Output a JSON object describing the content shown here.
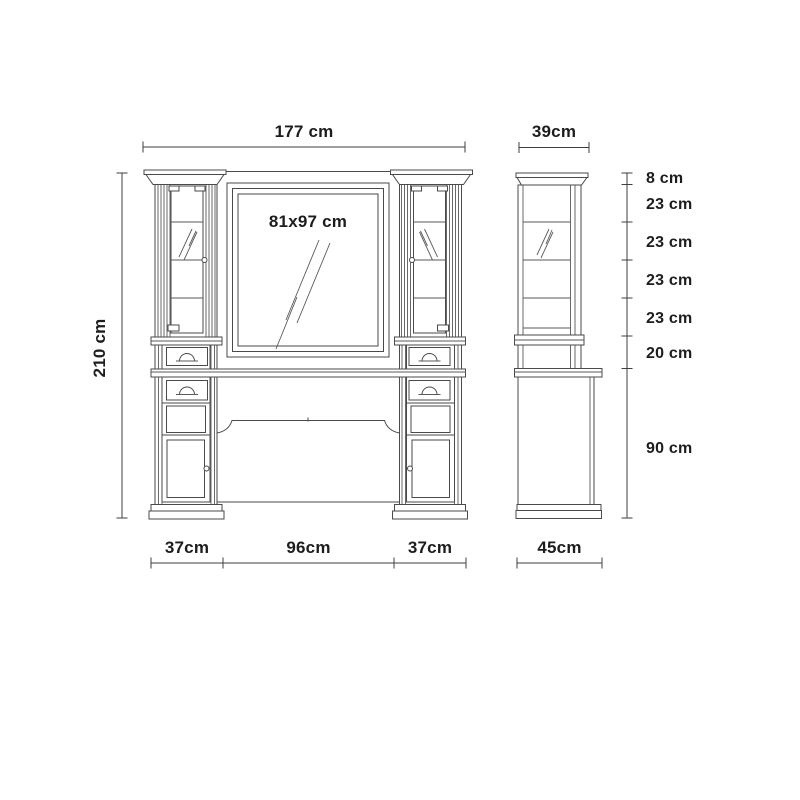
{
  "colors": {
    "background": "#ffffff",
    "line": "#4a4a4a",
    "dimension_line": "#3f3f3f",
    "text": "#1d1d1f"
  },
  "dimensions": {
    "front_width": {
      "label": "177 cm"
    },
    "front_height": {
      "label": "210 cm"
    },
    "mirror_size": {
      "label": "81x97 cm"
    },
    "side_top_width": {
      "label": "39cm"
    },
    "side_bottom_width": {
      "label": "45cm"
    },
    "front_bottom_segments": [
      {
        "label": "37cm"
      },
      {
        "label": "96cm"
      },
      {
        "label": "37cm"
      }
    ],
    "side_height_segments": [
      {
        "label": "8 cm"
      },
      {
        "label": "23 cm"
      },
      {
        "label": "23 cm"
      },
      {
        "label": "23 cm"
      },
      {
        "label": "23 cm"
      },
      {
        "label": "20 cm"
      },
      {
        "label": "90 cm"
      }
    ]
  }
}
